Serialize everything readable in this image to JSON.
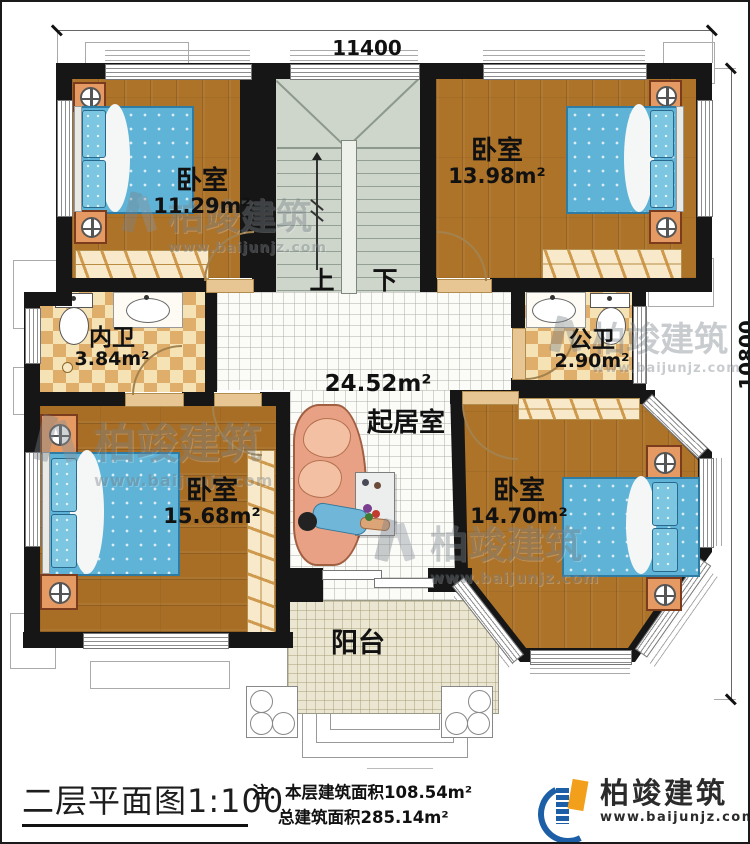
{
  "plan": {
    "dimensions": {
      "width_mm": "11400",
      "height_mm": "10800"
    },
    "rooms": [
      {
        "name": "卧室",
        "area": "11.29m²"
      },
      {
        "name": "卧室",
        "area": "13.98m²"
      },
      {
        "name": "内卫",
        "area": "3.84m²"
      },
      {
        "name": "公卫",
        "area": "2.90m²"
      },
      {
        "name": "起居室",
        "area": "24.52m²"
      },
      {
        "name": "卧室",
        "area": "15.68m²"
      },
      {
        "name": "卧室",
        "area": "14.70m²"
      },
      {
        "name": "阳台",
        "area": ""
      }
    ],
    "stairs": {
      "up": "上",
      "down": "下"
    }
  },
  "footer": {
    "title": "二层平面图",
    "scale": "1:100",
    "note_label": "注：",
    "note_line1": "本层建筑面积108.54m²",
    "note_line2": "总建筑面积285.14m²",
    "brand": "柏竣建筑",
    "website": "www.baijunjz.com"
  },
  "watermark": {
    "brand": "柏竣建筑",
    "website": "www.baijunjz.com"
  },
  "colors": {
    "wall": "#161616",
    "wood": "#ad7329",
    "stairs": "#ced5ca",
    "checker_dark": "#dfae6b",
    "checker_light": "#f5e2b5",
    "living_tile": "#fbfbf8",
    "balcony_tile": "#ebe6d1",
    "bed": "#5fb3d6",
    "sofa": "#e8a184",
    "logo_blue": "#1d5fa7",
    "logo_orange": "#f29f1b"
  }
}
